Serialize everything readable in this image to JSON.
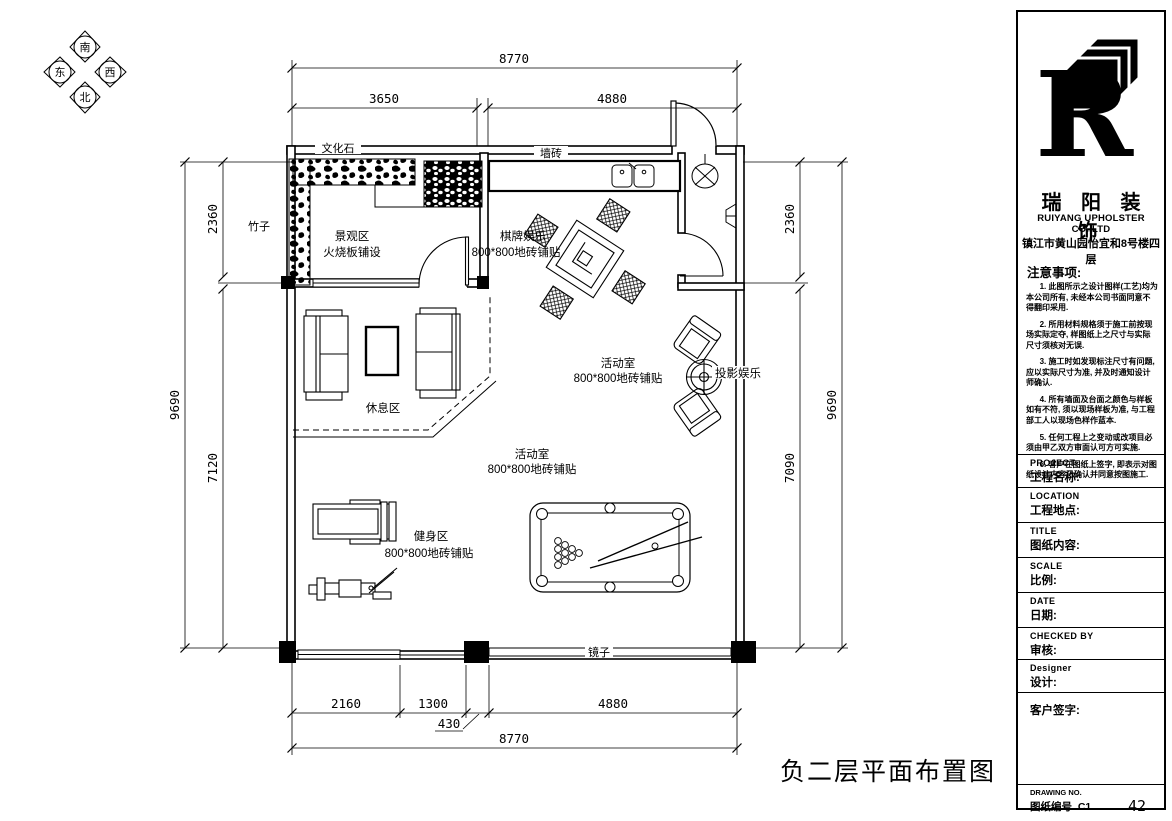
{
  "compass": {
    "top": "南",
    "bottom": "北",
    "left": "东",
    "right": "西"
  },
  "plan": {
    "title": "负二层平面布置图",
    "labels": {
      "cultural_stone": "文化石",
      "bamboo": "竹子",
      "landscape_area": "景观区",
      "landscape_floor": "火烧板铺设",
      "wall_tile": "墙砖",
      "chess_area": "棋牌娱乐",
      "tile_spec": "800*800地砖铺贴",
      "activity_room": "活动室",
      "projection": "投影娱乐",
      "rest_area": "休息区",
      "fitness_area": "健身区",
      "mirror": "镜子"
    },
    "dimensions": {
      "top_total": "8770",
      "top_left": "3650",
      "top_right": "4880",
      "left_total": "9690",
      "left_upper": "2360",
      "left_lower": "7120",
      "right_upper": "2360",
      "right_lower": "7090",
      "right_total": "9690",
      "bottom_1": "2160",
      "bottom_2": "1300",
      "bottom_3": "430",
      "bottom_4": "4880",
      "bottom_total": "8770"
    }
  },
  "titleblock": {
    "company_cn": "瑞 阳 装 饰",
    "company_en": "RUIYANG UPHOLSTER CO.,LTD",
    "address": "镇江市黄山园怡宜和8号楼四层",
    "notes_title": "注意事项:",
    "notes": [
      "1. 此图所示之设计图样(工艺)均为本公司所有, 未经本公司书面同意不得翻印采用.",
      "2. 所用材料规格须于施工前按现场实际定夺, 样图纸上之尺寸与实际尺寸须核对无误.",
      "3. 施工时如发现标注尺寸有问题, 应以实际尺寸为准, 并及时通知设计师确认.",
      "4. 所有墙面及台面之颜色与样板如有不符, 须以现场样板为准, 与工程部工人以现场色样作蓝本.",
      "5. 任何工程上之变动或改项目必须由甲乙双方审面认可方可实施.",
      "6. 客户在图纸上签字, 即表示对图纸设计内容已确认并同意按图施工."
    ],
    "fields": [
      {
        "en": "PROJECT",
        "cn": "工程名称:"
      },
      {
        "en": "LOCATION",
        "cn": "工程地点:"
      },
      {
        "en": "TITLE",
        "cn": "图纸内容:"
      },
      {
        "en": "SCALE",
        "cn": "比例:"
      },
      {
        "en": "DATE",
        "cn": "日期:"
      },
      {
        "en": "CHECKED BY",
        "cn": "审核:"
      },
      {
        "en": "Designer",
        "cn": "设计:"
      }
    ],
    "client_sign": "客户签字:",
    "drawing_no_en": "DRAWING NO.",
    "drawing_no_cn": "图纸编号",
    "drawing_no_value": "C1",
    "page_number": "42"
  }
}
